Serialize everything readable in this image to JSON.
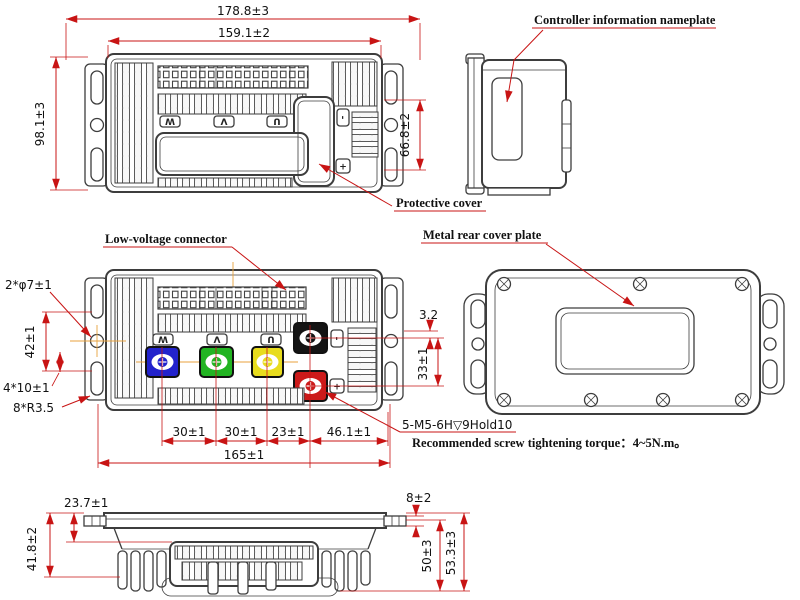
{
  "colors": {
    "line": "#3d3d3d",
    "dimension": "#c81414",
    "centerline": "#e8a23c",
    "terminal_blue": "#2222cc",
    "terminal_green": "#22b422",
    "terminal_yellow": "#e8dc1e",
    "terminal_black": "#141414",
    "terminal_red": "#cc1a1a"
  },
  "labels": {
    "nameplate": "Controller information nameplate",
    "protective_cover": "Protective cover",
    "low_voltage_connector": "Low-voltage connector",
    "metal_rear_cover": "Metal rear cover plate",
    "screw_spec": "5-M5-6H▽9Hold10",
    "torque_note": "Recommended screw tightening torque：4~5N.m。"
  },
  "dims": {
    "overall_width": "178.8±3",
    "inner_width": "159.1±2",
    "overall_depth": "98.1±3",
    "cover_depth": "66.8±2",
    "mount_hole": "2*φ7±1",
    "hole_pitch": "42±1",
    "slot": "4*10±1",
    "fillet": "8*R3.5",
    "offset_small": "3.2",
    "terminal_pitch_v": "33±1",
    "pitch_w_v": "30±1",
    "pitch_v_u": "30±1",
    "pitch_u_b": "23±1",
    "pitch_b_edge": "46.1±1",
    "mount_span": "165±1",
    "fin_inset": "23.7±1",
    "front_height": "41.8±2",
    "tab_thickness": "8±2",
    "side_height": "50±3",
    "overall_height": "53.3±3"
  },
  "marks": {
    "w": "W",
    "v": "V",
    "u": "U",
    "minus": "-",
    "plus": "+"
  }
}
